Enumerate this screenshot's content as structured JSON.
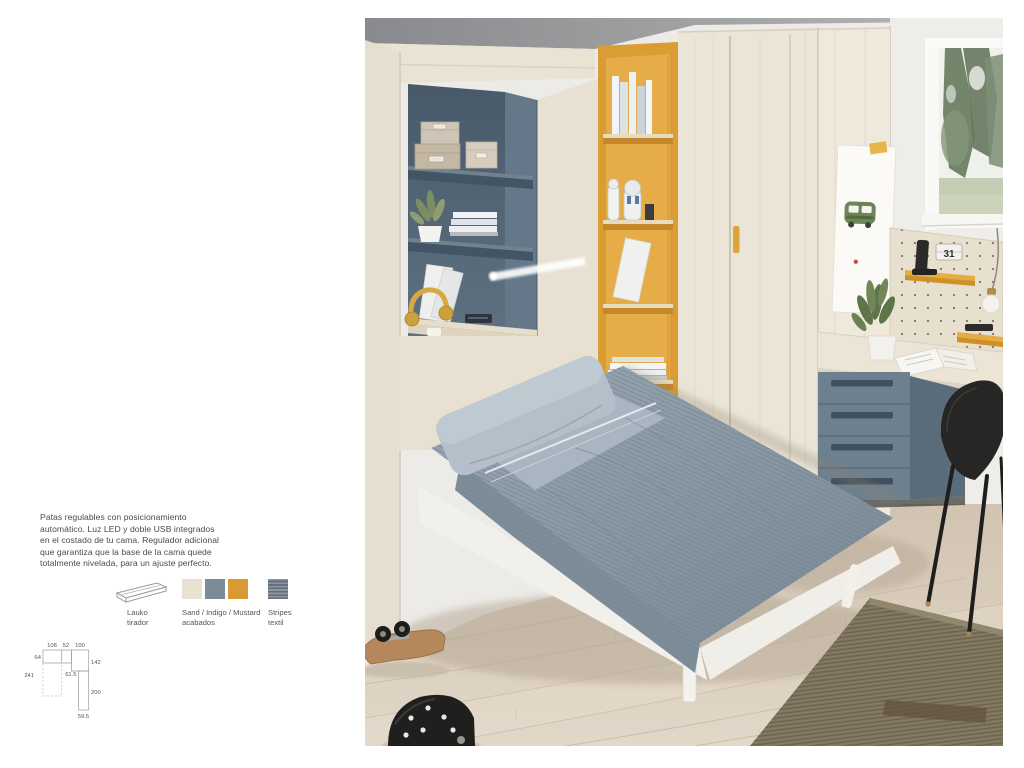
{
  "description": {
    "lines": [
      "Patas regulables con posicionamiento",
      "automático. Luz LED y doble USB integrados",
      "en el costado de tu cama. Regulador adicional",
      "que garantiza que la base de la cama quede",
      "totalmente nivelada, para un ajuste perfecto."
    ]
  },
  "legend": {
    "handle": {
      "line1": "Lauko",
      "line2": "tirador"
    },
    "finishes": {
      "line1": "Sand / Indigo / Mustard",
      "line2": "acabados",
      "sand_color": "#e9e2d1",
      "indigo_color": "#7b8b98",
      "mustard_color": "#d89a33"
    },
    "textile": {
      "line1": "Stripes",
      "line2": "textil",
      "base_color": "#7d8893"
    }
  },
  "diagram": {
    "top_widths": [
      "108",
      "52",
      "100"
    ],
    "left_height": "64",
    "total_depth": "241",
    "right_upper": "142",
    "mid_depth": "61.5",
    "right_lower": "200",
    "bottom_width": "59.5"
  },
  "photo": {
    "calendar_day": "31",
    "palette": {
      "wood_sand": "#e9e2d2",
      "indigo_panel": "#546878",
      "mustard": "#d99b2e",
      "floor": "#dccfbf",
      "bedding": "#8d9ca9",
      "ceiling": "#8f9093",
      "rug": "#7d745e"
    }
  }
}
